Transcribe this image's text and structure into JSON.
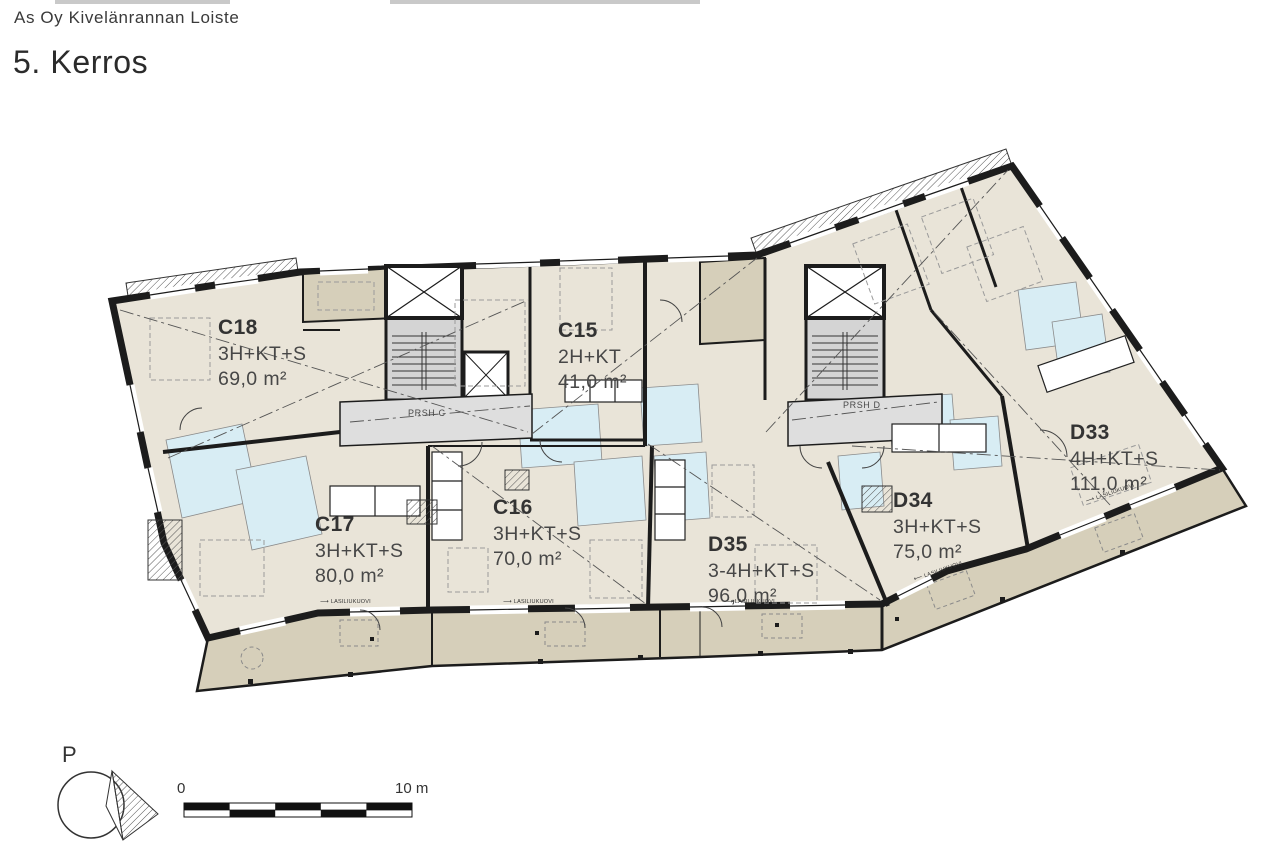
{
  "header": {
    "project": "As Oy Kivelänrannan Loiste",
    "floor": "5. Kerros"
  },
  "units": [
    {
      "id": "C18",
      "type": "3H+KT+S",
      "area": "69,0 m²"
    },
    {
      "id": "C15",
      "type": "2H+KT",
      "area": "41,0 m²"
    },
    {
      "id": "C17",
      "type": "3H+KT+S",
      "area": "80,0 m²"
    },
    {
      "id": "C16",
      "type": "3H+KT+S",
      "area": "70,0 m²"
    },
    {
      "id": "D35",
      "type": "3-4H+KT+S",
      "area": "96,0 m²"
    },
    {
      "id": "D34",
      "type": "3H+KT+S",
      "area": "75,0 m²"
    },
    {
      "id": "D33",
      "type": "4H+KT+S",
      "area": "111,0 m²"
    }
  ],
  "stairwells": {
    "c": "PRSH C",
    "d": "PRSH D"
  },
  "labels": {
    "sliding_door": "LASILIUKUOVI"
  },
  "compass": {
    "north_abbrev": "P"
  },
  "scale_bar": {
    "start": "0",
    "end": "10 m"
  },
  "colors": {
    "apartment": "#e9e4d8",
    "balcony": "#d6cfba",
    "wet_room": "#d8edf4",
    "core": "#d4d4d4",
    "corridor": "#dedede",
    "wall": "#1c1c1c"
  }
}
